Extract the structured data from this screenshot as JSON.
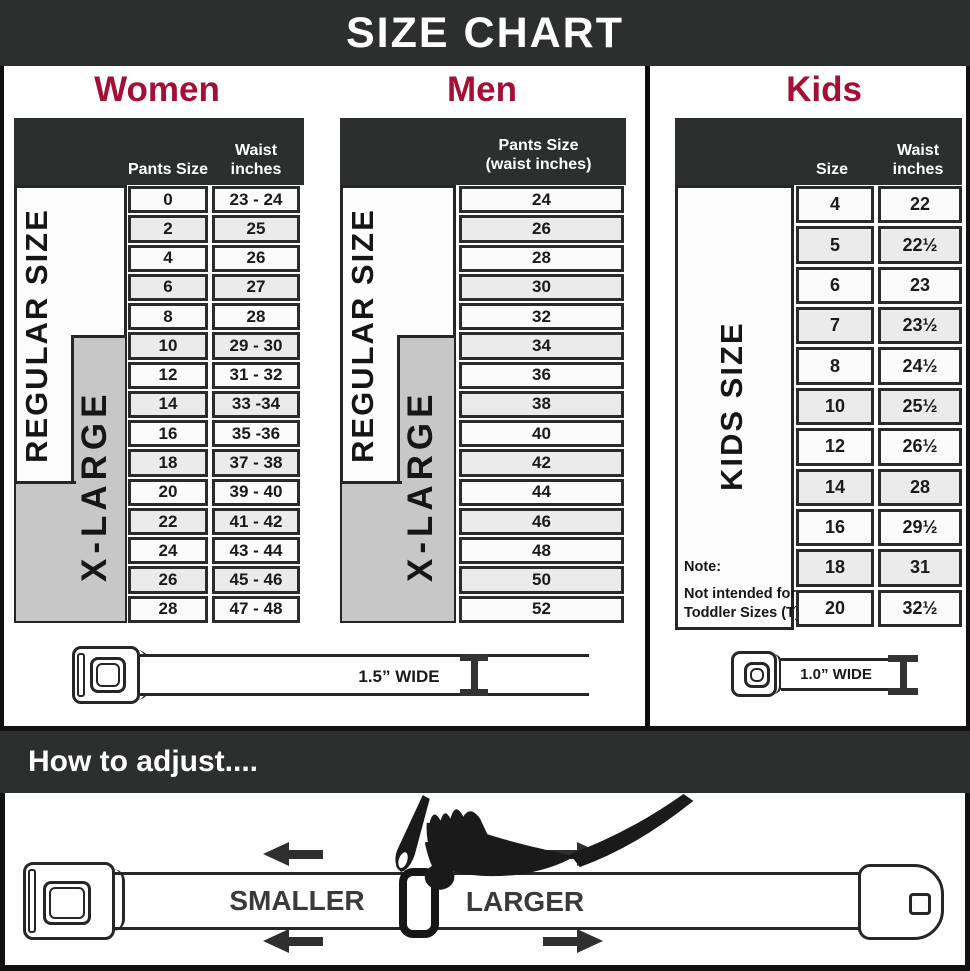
{
  "title": "SIZE CHART",
  "colors": {
    "header_bar": "#2d2e2e",
    "heading_red": "#a50f36",
    "xlarge_gray": "#c7c7c7",
    "border": "#262626"
  },
  "sections": {
    "women": {
      "heading": "Women",
      "col1_header": "Pants Size",
      "col2_header_line1": "Waist",
      "col2_header_line2": "inches",
      "regular_label": "REGULAR SIZE",
      "xlarge_label": "X-LARGE",
      "rows": [
        {
          "size": "0",
          "waist": "23 - 24"
        },
        {
          "size": "2",
          "waist": "25"
        },
        {
          "size": "4",
          "waist": "26"
        },
        {
          "size": "6",
          "waist": "27"
        },
        {
          "size": "8",
          "waist": "28"
        },
        {
          "size": "10",
          "waist": "29 - 30"
        },
        {
          "size": "12",
          "waist": "31 - 32"
        },
        {
          "size": "14",
          "waist": "33 -34"
        },
        {
          "size": "16",
          "waist": "35 -36"
        },
        {
          "size": "18",
          "waist": "37 - 38"
        },
        {
          "size": "20",
          "waist": "39 - 40"
        },
        {
          "size": "22",
          "waist": "41 - 42"
        },
        {
          "size": "24",
          "waist": "43 - 44"
        },
        {
          "size": "26",
          "waist": "45 - 46"
        },
        {
          "size": "28",
          "waist": "47 - 48"
        }
      ]
    },
    "men": {
      "heading": "Men",
      "header_line1": "Pants Size",
      "header_line2": "(waist inches)",
      "regular_label": "REGULAR SIZE",
      "xlarge_label": "X-LARGE",
      "rows": [
        "24",
        "26",
        "28",
        "30",
        "32",
        "34",
        "36",
        "38",
        "40",
        "42",
        "44",
        "46",
        "48",
        "50",
        "52"
      ]
    },
    "kids": {
      "heading": "Kids",
      "col1_header": "Size",
      "col2_header_line1": "Waist",
      "col2_header_line2": "inches",
      "side_label": "KIDS SIZE",
      "note_title": "Note:",
      "note_line1": "Not intended for",
      "note_line2": "Toddler Sizes (T)",
      "rows": [
        {
          "size": "4",
          "waist": "22"
        },
        {
          "size": "5",
          "waist": "22½"
        },
        {
          "size": "6",
          "waist": "23"
        },
        {
          "size": "7",
          "waist": "23½"
        },
        {
          "size": "8",
          "waist": "24½"
        },
        {
          "size": "10",
          "waist": "25½"
        },
        {
          "size": "12",
          "waist": "26½"
        },
        {
          "size": "14",
          "waist": "28"
        },
        {
          "size": "16",
          "waist": "29½"
        },
        {
          "size": "18",
          "waist": "31"
        },
        {
          "size": "20",
          "waist": "32½"
        }
      ]
    }
  },
  "belts": {
    "adult_width_label": "1.5” WIDE",
    "kids_width_label": "1.0” WIDE"
  },
  "adjust": {
    "heading": "How to adjust....",
    "smaller_label": "SMALLER",
    "larger_label": "LARGER"
  }
}
